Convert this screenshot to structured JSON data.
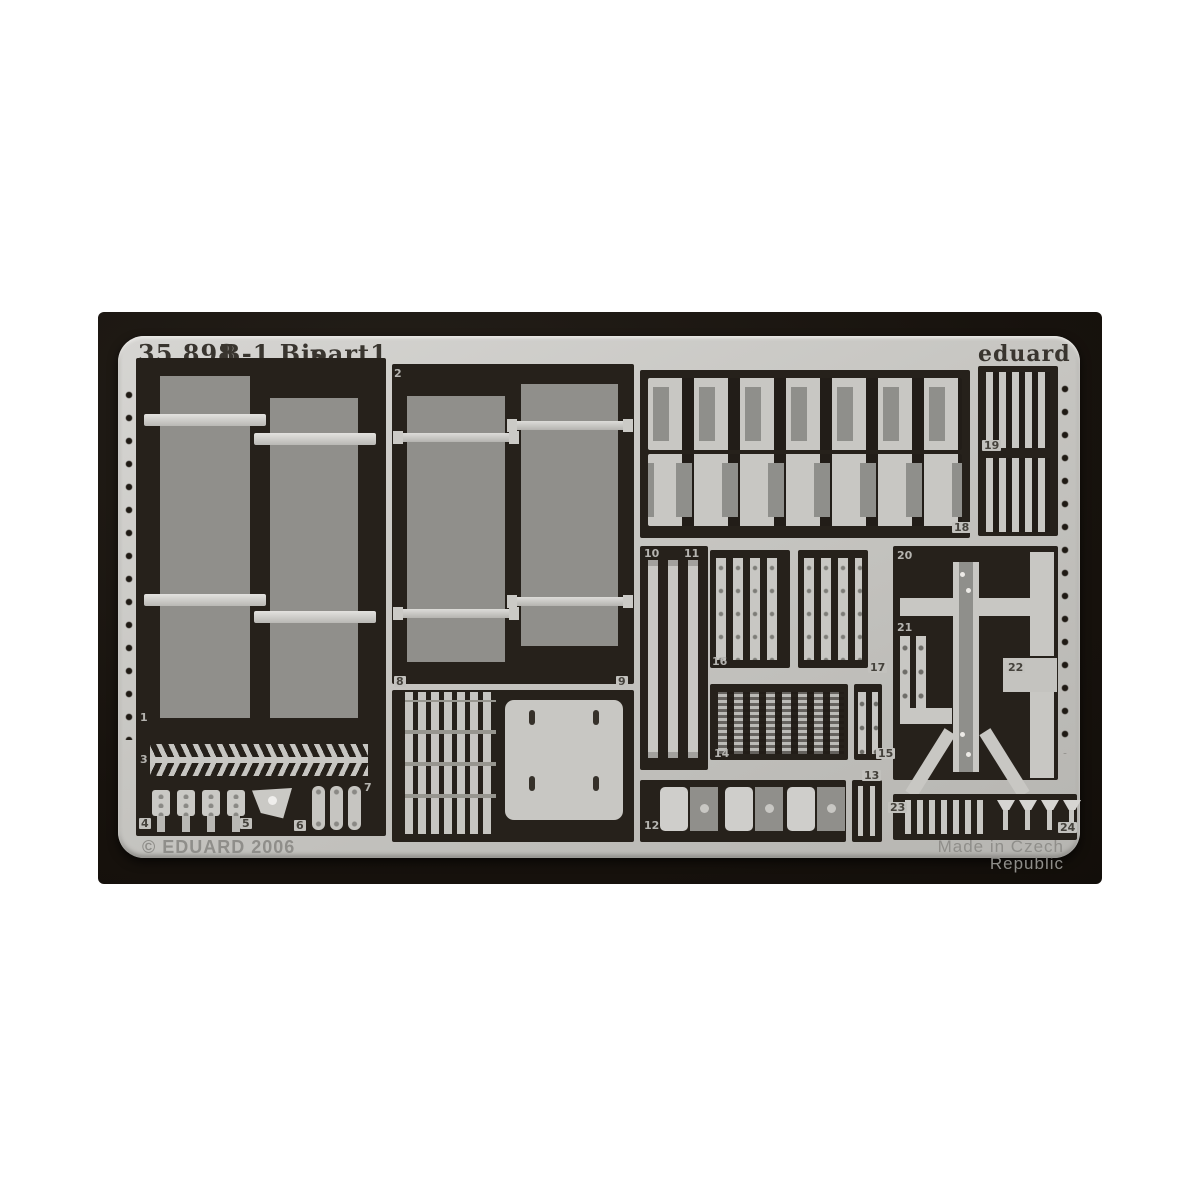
{
  "photo": {
    "subject": "Eduard photo-etched detail fret product photo"
  },
  "header": {
    "catalog": "35 898",
    "kit": "B-1 Bis",
    "sheet": "part1",
    "brand": "eduard"
  },
  "footer": {
    "copyright": "© EDUARD 2006",
    "origin": "Made in Czech Republic"
  },
  "colors": {
    "sheet": "#c7c6c2",
    "half_etch_grey": "#908f8b",
    "etched_dark": "#26211b",
    "mat": "#17120d",
    "strap_light": "#dddcd9"
  },
  "parts": [
    {
      "label": "1"
    },
    {
      "label": "2"
    },
    {
      "label": "3"
    },
    {
      "label": "4"
    },
    {
      "label": "5"
    },
    {
      "label": "6"
    },
    {
      "label": "7"
    },
    {
      "label": "8"
    },
    {
      "label": "9"
    },
    {
      "label": "10"
    },
    {
      "label": "11"
    },
    {
      "label": "12"
    },
    {
      "label": "13"
    },
    {
      "label": "14"
    },
    {
      "label": "15"
    },
    {
      "label": "16"
    },
    {
      "label": "17"
    },
    {
      "label": "18"
    },
    {
      "label": "19"
    },
    {
      "label": "20"
    },
    {
      "label": "21"
    },
    {
      "label": "22"
    },
    {
      "label": "23"
    },
    {
      "label": "24"
    }
  ]
}
